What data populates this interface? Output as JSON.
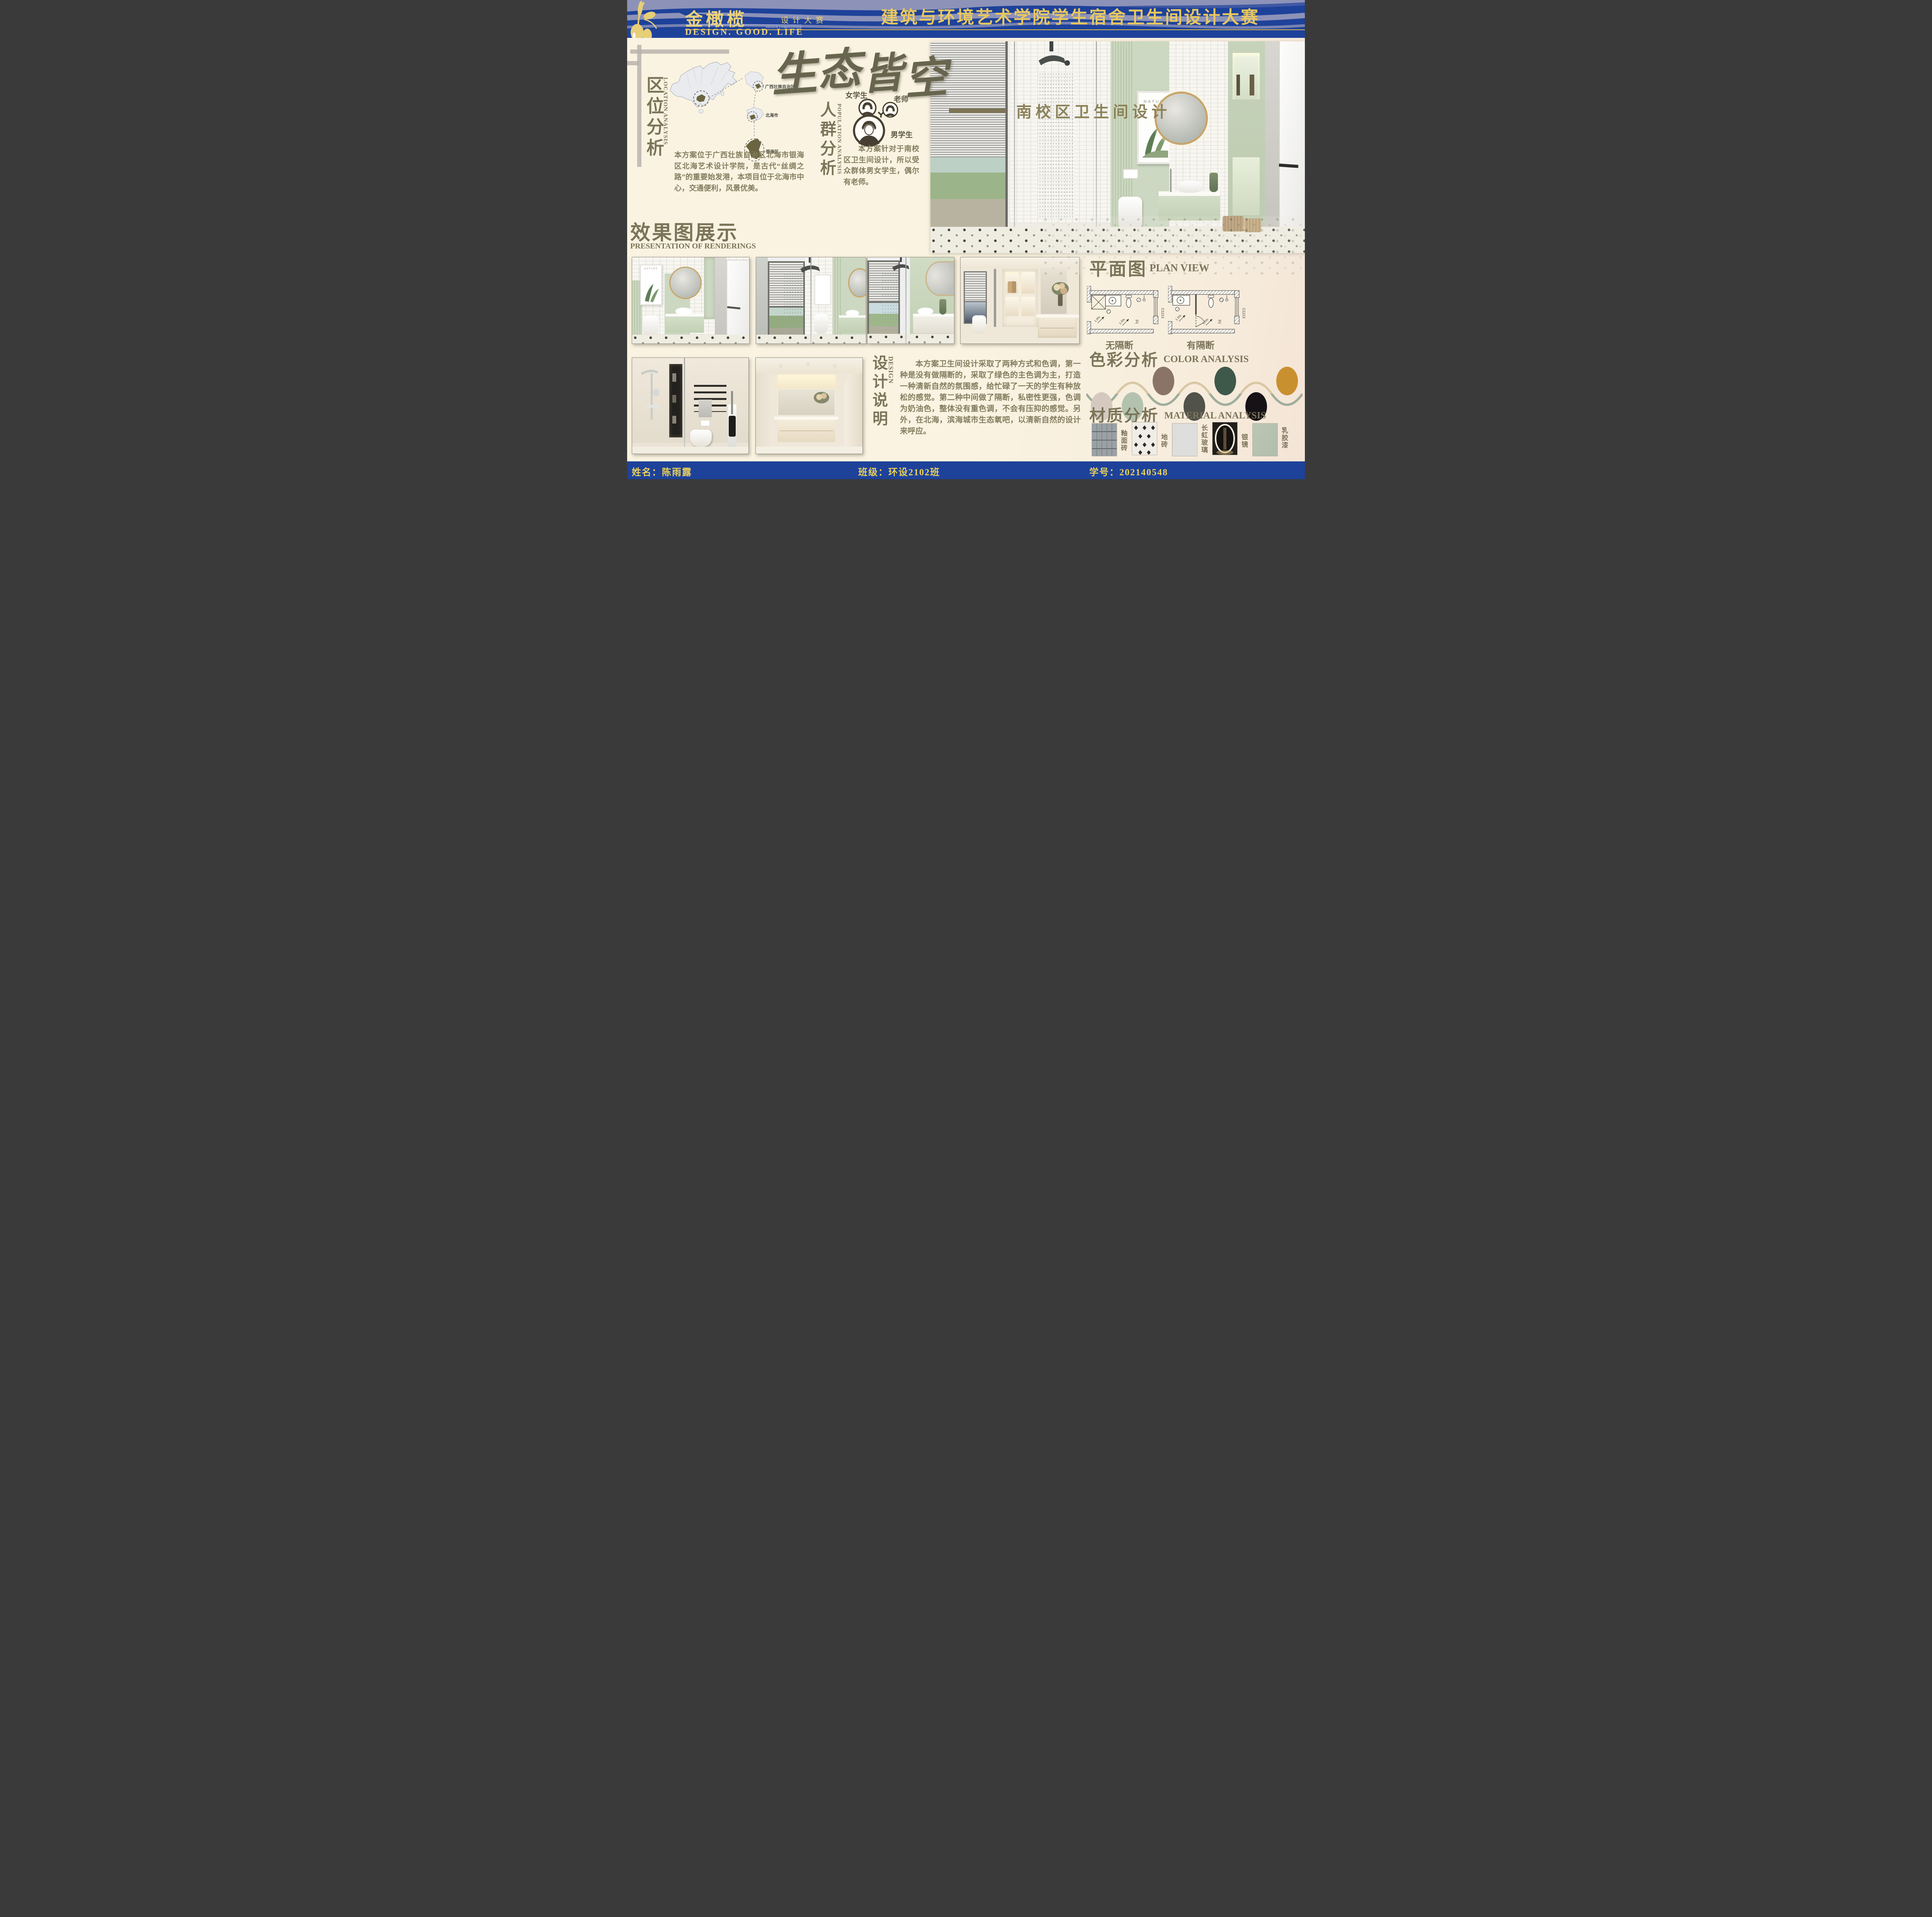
{
  "theme": {
    "blue": "#1e429a",
    "gold": "#e9c85e",
    "olive": "#7b7459",
    "cream": "#faf3e1",
    "sage": "#ccd8c1"
  },
  "header": {
    "logo_cn": "金橄榄",
    "logo_sep": "·",
    "logo_sub": "设计大赛",
    "logo_sub_en": "DESIGN COMPETITION",
    "tagline": "DESIGN.  GOOD.  LIFE",
    "title": "建筑与环境艺术学院学生宿舍卫生间设计大赛"
  },
  "calligraphy": {
    "chars": [
      "生",
      "态",
      "皆",
      "空"
    ]
  },
  "hero": {
    "caption": "南校区卫生间设计",
    "poster_label": "NATURE"
  },
  "location": {
    "title_cn": "区位分析",
    "title_en": "LOCATION ANALYSIS",
    "map_labels": [
      "广西壮族自治区",
      "北海市",
      "银海区"
    ],
    "body": "本方案位于广西壮族自治区北海市银海区北海艺术设计学院，是古代“丝绸之路”的重要始发港，本项目位于北海市中心，交通便利，风景优美。"
  },
  "population": {
    "title_cn": "人群分析",
    "title_en": "POPULATION ANALYSIS",
    "groups": [
      "女学生",
      "老师",
      "男学生"
    ],
    "body": "本方案针对于南校区卫生间设计，所以受众群体男女学生，偶尔有老师。"
  },
  "renderings": {
    "title_cn": "效果图展示",
    "title_en": "PRESENTATION OF RENDERINGS"
  },
  "plan": {
    "title_cn": "平面图",
    "title_en": "PLAN VIEW",
    "variants": [
      "无隔断",
      "有隔断"
    ],
    "window_code": "C1213",
    "slope": "1.5%",
    "room": "卫"
  },
  "design_note": {
    "title_cn": "设计说明",
    "title_en": "DESIGN",
    "body": "本方案卫生间设计采取了两种方式和色调，第一种是没有做隔断的，采取了绿色的主色调为主，打造一种清新自然的氛围感，给忙碌了一天的学生有种放松的感觉。第二种中间做了隔断，私密性更强，色调为奶油色，整体没有重色调，不会有压抑的感觉。另外，在北海，滨海城市生态氧吧，以清新自然的设计来呼应。"
  },
  "color_analysis": {
    "title_cn": "色彩分析",
    "title_en": "COLOR ANALYSIS",
    "swatches": [
      "#d5c9bf",
      "#b3c2af",
      "#8a7468",
      "#51524a",
      "#3e5949",
      "#161216",
      "#c9902f"
    ]
  },
  "material_analysis": {
    "title_cn": "材质分析",
    "title_en": "MATERIAL ANALYSIS",
    "items": [
      "釉面砖",
      "地砖",
      "长虹玻璃",
      "银镜",
      "乳胶漆"
    ]
  },
  "footer": {
    "name": "姓名：陈雨露",
    "class": "班级：环设2102班",
    "student_id": "学号：202140548"
  }
}
